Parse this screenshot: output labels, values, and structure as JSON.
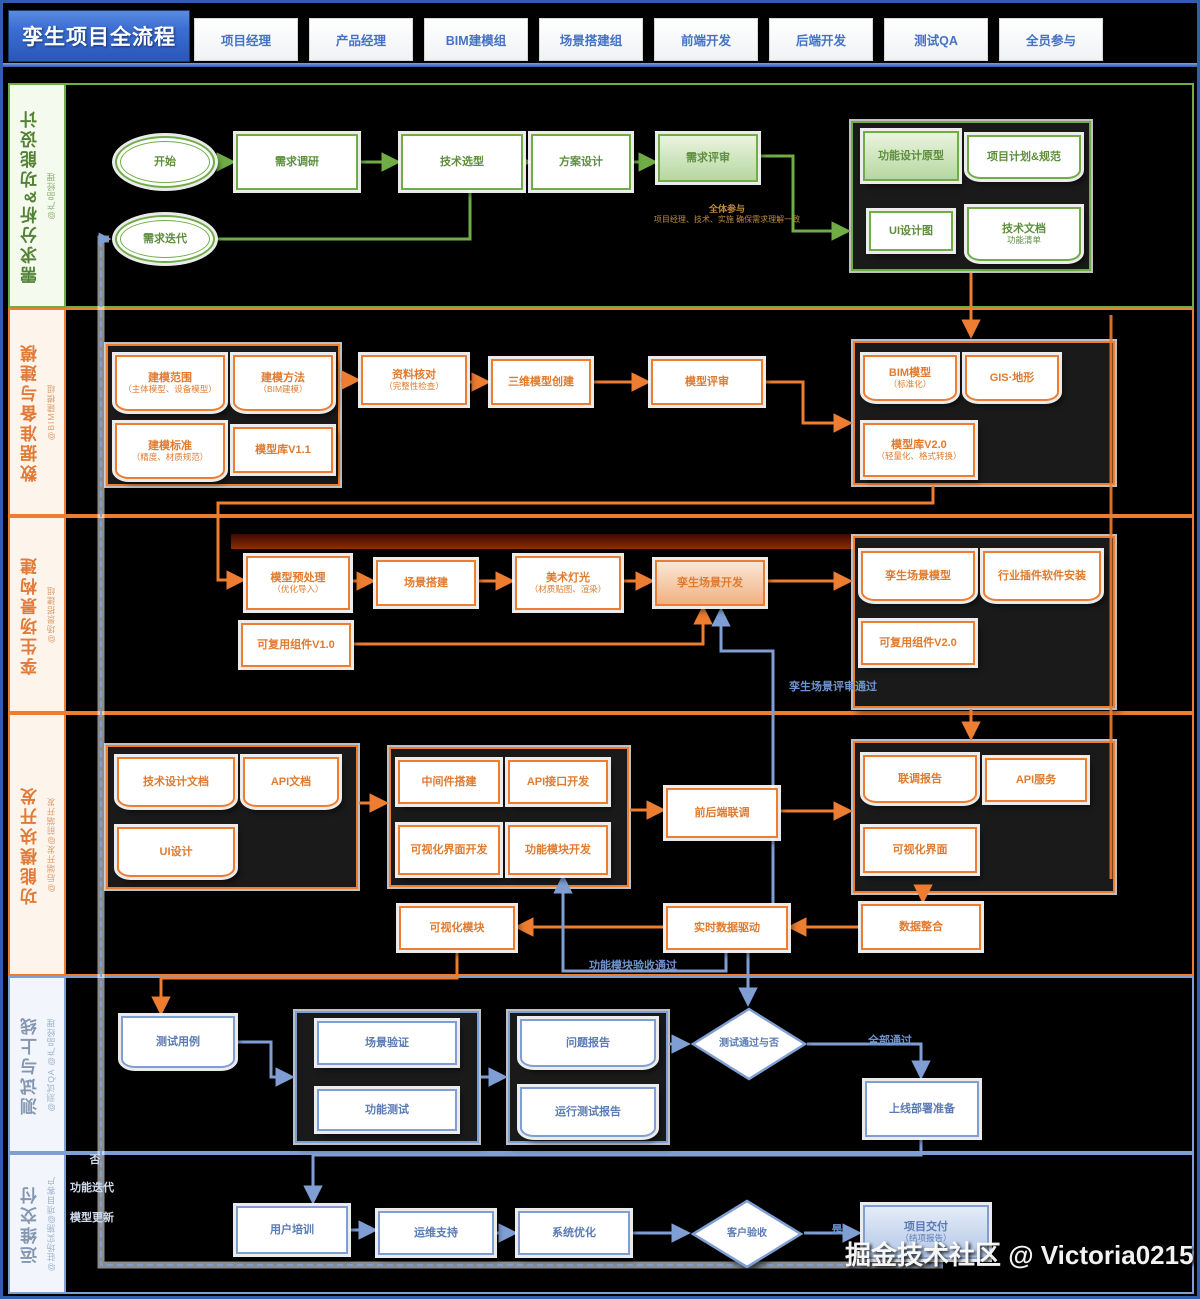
{
  "title": "孪生项目全流程",
  "header": {
    "roles": [
      "项目经理",
      "产品经理",
      "BIM建模组",
      "场景搭建组",
      "前端开发",
      "后端开发",
      "测试QA",
      "全员参与"
    ]
  },
  "lanes": [
    {
      "title": "需求分析&功能设计",
      "owner": "@产品经理",
      "color": "#70ad47"
    },
    {
      "title": "数据准备与建模",
      "owner": "@BIM建模组",
      "color": "#ed7d31"
    },
    {
      "title": "孪生场景构建",
      "owner": "@场景搭建组",
      "color": "#ed7d31"
    },
    {
      "title": "功能模块开发",
      "owner": "@后端开发@前端开发",
      "color": "#ed7d31"
    },
    {
      "title": "测试与上线",
      "owner": "@测试QA @产品经理",
      "color": "#7f9fd4"
    },
    {
      "title": "运维交付",
      "owner": "@驻场实施@项目客户",
      "color": "#7f9fd4"
    }
  ],
  "colors": {
    "green": "#70ad47",
    "orange": "#ed7d31",
    "blue": "#7f9fd4",
    "header_accent": "#4472c4",
    "highlight_red": "#8e2c0a"
  },
  "nodes": [
    {
      "id": "start",
      "text": "开始"
    },
    {
      "id": "req-research",
      "text": "需求调研"
    },
    {
      "id": "tech-select",
      "text": "技术选型"
    },
    {
      "id": "plan-design",
      "text": "方案设计"
    },
    {
      "id": "req-review",
      "text": "需求评审"
    },
    {
      "id": "review-note",
      "text": "全体参与",
      "sub": "项目经理、技术、实施 确保需求理解一致"
    },
    {
      "id": "func-proto",
      "text": "功能设计原型"
    },
    {
      "id": "plan-spec",
      "text": "项目计划&规范"
    },
    {
      "id": "ui-design-doc",
      "text": "UI设计图"
    },
    {
      "id": "tech-doc",
      "text": "技术文档",
      "sub": "功能清单"
    },
    {
      "id": "req-iterate",
      "text": "需求迭代"
    },
    {
      "id": "scope",
      "text": "建模范围",
      "sub": "（主体模型、设备模型）"
    },
    {
      "id": "method",
      "text": "建模方法",
      "sub": "（BIM建模）"
    },
    {
      "id": "standard",
      "text": "建模标准",
      "sub": "（精度、材质规范）"
    },
    {
      "id": "lib-v11",
      "text": "模型库V1.1"
    },
    {
      "id": "data-check",
      "text": "资料核对",
      "sub": "（完整性检查）"
    },
    {
      "id": "model-create",
      "text": "三维模型创建"
    },
    {
      "id": "model-review",
      "text": "模型评审"
    },
    {
      "id": "bim-model",
      "text": "BIM模型",
      "sub": "（标准化）"
    },
    {
      "id": "gis",
      "text": "GIS·地形"
    },
    {
      "id": "lib-v20",
      "text": "模型库V2.0",
      "sub": "（轻量化、格式转换）"
    },
    {
      "id": "preprocess",
      "text": "模型预处理",
      "sub": "（优化导入）"
    },
    {
      "id": "scene-build",
      "text": "场景搭建"
    },
    {
      "id": "art-light",
      "text": "美术灯光",
      "sub": "（材质贴图、渲染）"
    },
    {
      "id": "twin-dev",
      "text": "孪生场景开发"
    },
    {
      "id": "comp-v10",
      "text": "可复用组件V1.0"
    },
    {
      "id": "twin-model",
      "text": "孪生场景模型"
    },
    {
      "id": "plugin",
      "text": "行业插件软件安装"
    },
    {
      "id": "comp-v20",
      "text": "可复用组件V2.0"
    },
    {
      "id": "lbl-scene-pass",
      "text": "孪生场景评审通过"
    },
    {
      "id": "tech-design",
      "text": "技术设计文档"
    },
    {
      "id": "api-doc",
      "text": "API文档"
    },
    {
      "id": "ui-doc",
      "text": "UI设计"
    },
    {
      "id": "middleware",
      "text": "中间件搭建"
    },
    {
      "id": "api-dev",
      "text": "API接口开发"
    },
    {
      "id": "viz-dev",
      "text": "可视化界面开发"
    },
    {
      "id": "func-dev",
      "text": "功能模块开发"
    },
    {
      "id": "joint-debug",
      "text": "前后端联调"
    },
    {
      "id": "debug-report",
      "text": "联调报告"
    },
    {
      "id": "api-svc",
      "text": "API服务"
    },
    {
      "id": "viz-ui",
      "text": "可视化界面"
    },
    {
      "id": "viz-module",
      "text": "可视化模块"
    },
    {
      "id": "data-drive",
      "text": "实时数据驱动"
    },
    {
      "id": "data-merge",
      "text": "数据整合"
    },
    {
      "id": "lbl-func-pass",
      "text": "功能模块验收通过"
    },
    {
      "id": "test-case",
      "text": "测试用例"
    },
    {
      "id": "scene-verify",
      "text": "场景验证"
    },
    {
      "id": "func-test",
      "text": "功能测试"
    },
    {
      "id": "issue-report",
      "text": "问题报告"
    },
    {
      "id": "run-report",
      "text": "运行测试报告"
    },
    {
      "id": "test-pass",
      "text": "测试通过与否"
    },
    {
      "id": "lbl-all-pass",
      "text": "全部通过"
    },
    {
      "id": "deploy-prep",
      "text": "上线部署准备"
    },
    {
      "id": "lbl-no",
      "text": "否"
    },
    {
      "id": "lbl-func-iter",
      "text": "功能迭代"
    },
    {
      "id": "lbl-model-update",
      "text": "模型更新"
    },
    {
      "id": "user-training",
      "text": "用户培训"
    },
    {
      "id": "ops-support",
      "text": "运维支持"
    },
    {
      "id": "sys-optimize",
      "text": "系统优化"
    },
    {
      "id": "accept",
      "text": "客户验收"
    },
    {
      "id": "lbl-yes",
      "text": "是"
    },
    {
      "id": "delivery",
      "text": "项目交付",
      "sub": "（结项报告）"
    }
  ],
  "watermark": "掘金技术社区 @ Victoria0215"
}
